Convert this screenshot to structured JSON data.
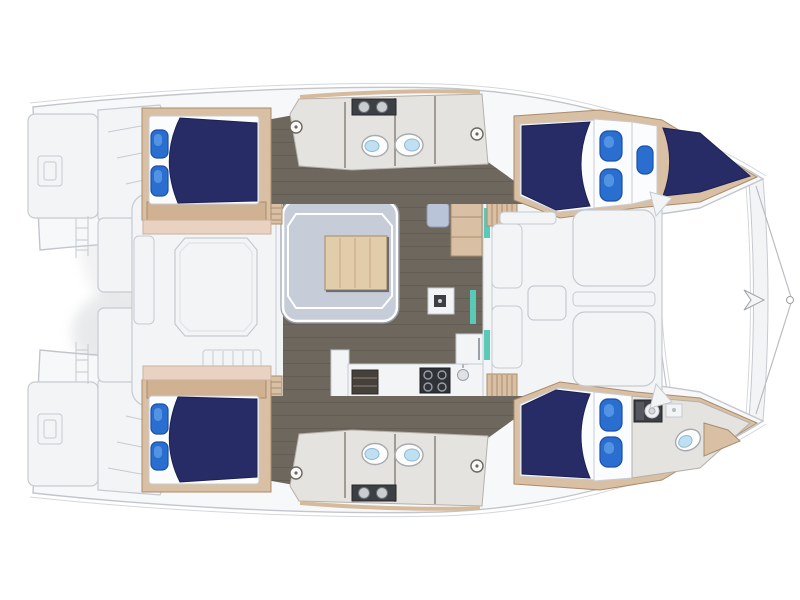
{
  "figure": {
    "kind": "catamaran yacht deck plan",
    "view": "overhead floor plan",
    "bow_direction": "right",
    "hull_count": 2
  },
  "colors": {
    "page_bg": "#ffffff",
    "hull_fill": "#f7f8f9",
    "hull_line": "#c2c6cc",
    "sheer_line": "#d4d7db",
    "deck_white": "#f3f4f6",
    "deck_line": "#c6cad0",
    "floor_dark": "#6e675e",
    "floor_light": "#e4e3df",
    "wall_line": "#b5b0a8",
    "wall_line2": "#8f8a82",
    "wood_light": "#d9c0a4",
    "wood_mid": "#d0b191",
    "wood_dark": "#a98c6d",
    "wood_pink": "#ead2c2",
    "wood_pink_line": "#cbb1a0",
    "navy": "#272c66",
    "navy_line": "#1b2050",
    "accent_blue": "#2a6fd0",
    "accent_blue_dark": "#1c4fa8",
    "accent_blue_hi": "#5b9ae6",
    "settee": "#c6ccd8",
    "settee_line": "#9aa0ad",
    "table_wood": "#e2cdab",
    "table_wood_line": "#b09574",
    "table_grain": "#cdb48f",
    "appliance_dark": "#2f3237",
    "steel": "#9aa0a8",
    "teal": "#59cab8",
    "toilet_blue": "#bfe0f2",
    "net_dot": "#cdd0d5",
    "shadow": "#9aa0a6"
  },
  "layout": {
    "stern": {
      "port_transom": "swim platform with boarding steps and ladder",
      "starboard_transom": "swim platform with boarding steps and ladder"
    },
    "aft_cockpit": {
      "items": [
        "cockpit-table",
        "bench-seat-top",
        "bench-seat-left",
        "slatted-bench"
      ]
    },
    "saloon": {
      "items": [
        "u-settee",
        "saloon-table",
        "nav-seat",
        "sideboard",
        "island-sink",
        "wardrobe",
        "forward-door-teal-glass"
      ]
    },
    "galley": {
      "items": [
        "cooktop-4-burner",
        "galley-sink",
        "fridge",
        "shelf-unit",
        "l-counter",
        "drawer-bank"
      ]
    },
    "forward_cockpit": {
      "items": [
        "bench-seats",
        "sun-pads",
        "side-table"
      ]
    },
    "bow": {
      "items": [
        "trampoline-net",
        "forestay-fitting",
        "bowsprit-lines"
      ]
    },
    "port_hull": {
      "position": "top",
      "spaces": [
        "aft-double-cabin",
        "aft-head",
        "forward-head",
        "forward-double-cabin",
        "forepeak-berth"
      ],
      "companionways": 2
    },
    "starboard_hull": {
      "position": "bottom",
      "spaces": [
        "aft-double-cabin",
        "aft-head",
        "forward-head",
        "forward-double-cabin",
        "bow-head"
      ],
      "companionways": 2
    },
    "counts": {
      "double_berths": 5,
      "toilets": 5,
      "wash_basins": 5,
      "shower_heads": 4,
      "blue_hull_windows": 4,
      "blue_pillows": 5
    }
  }
}
